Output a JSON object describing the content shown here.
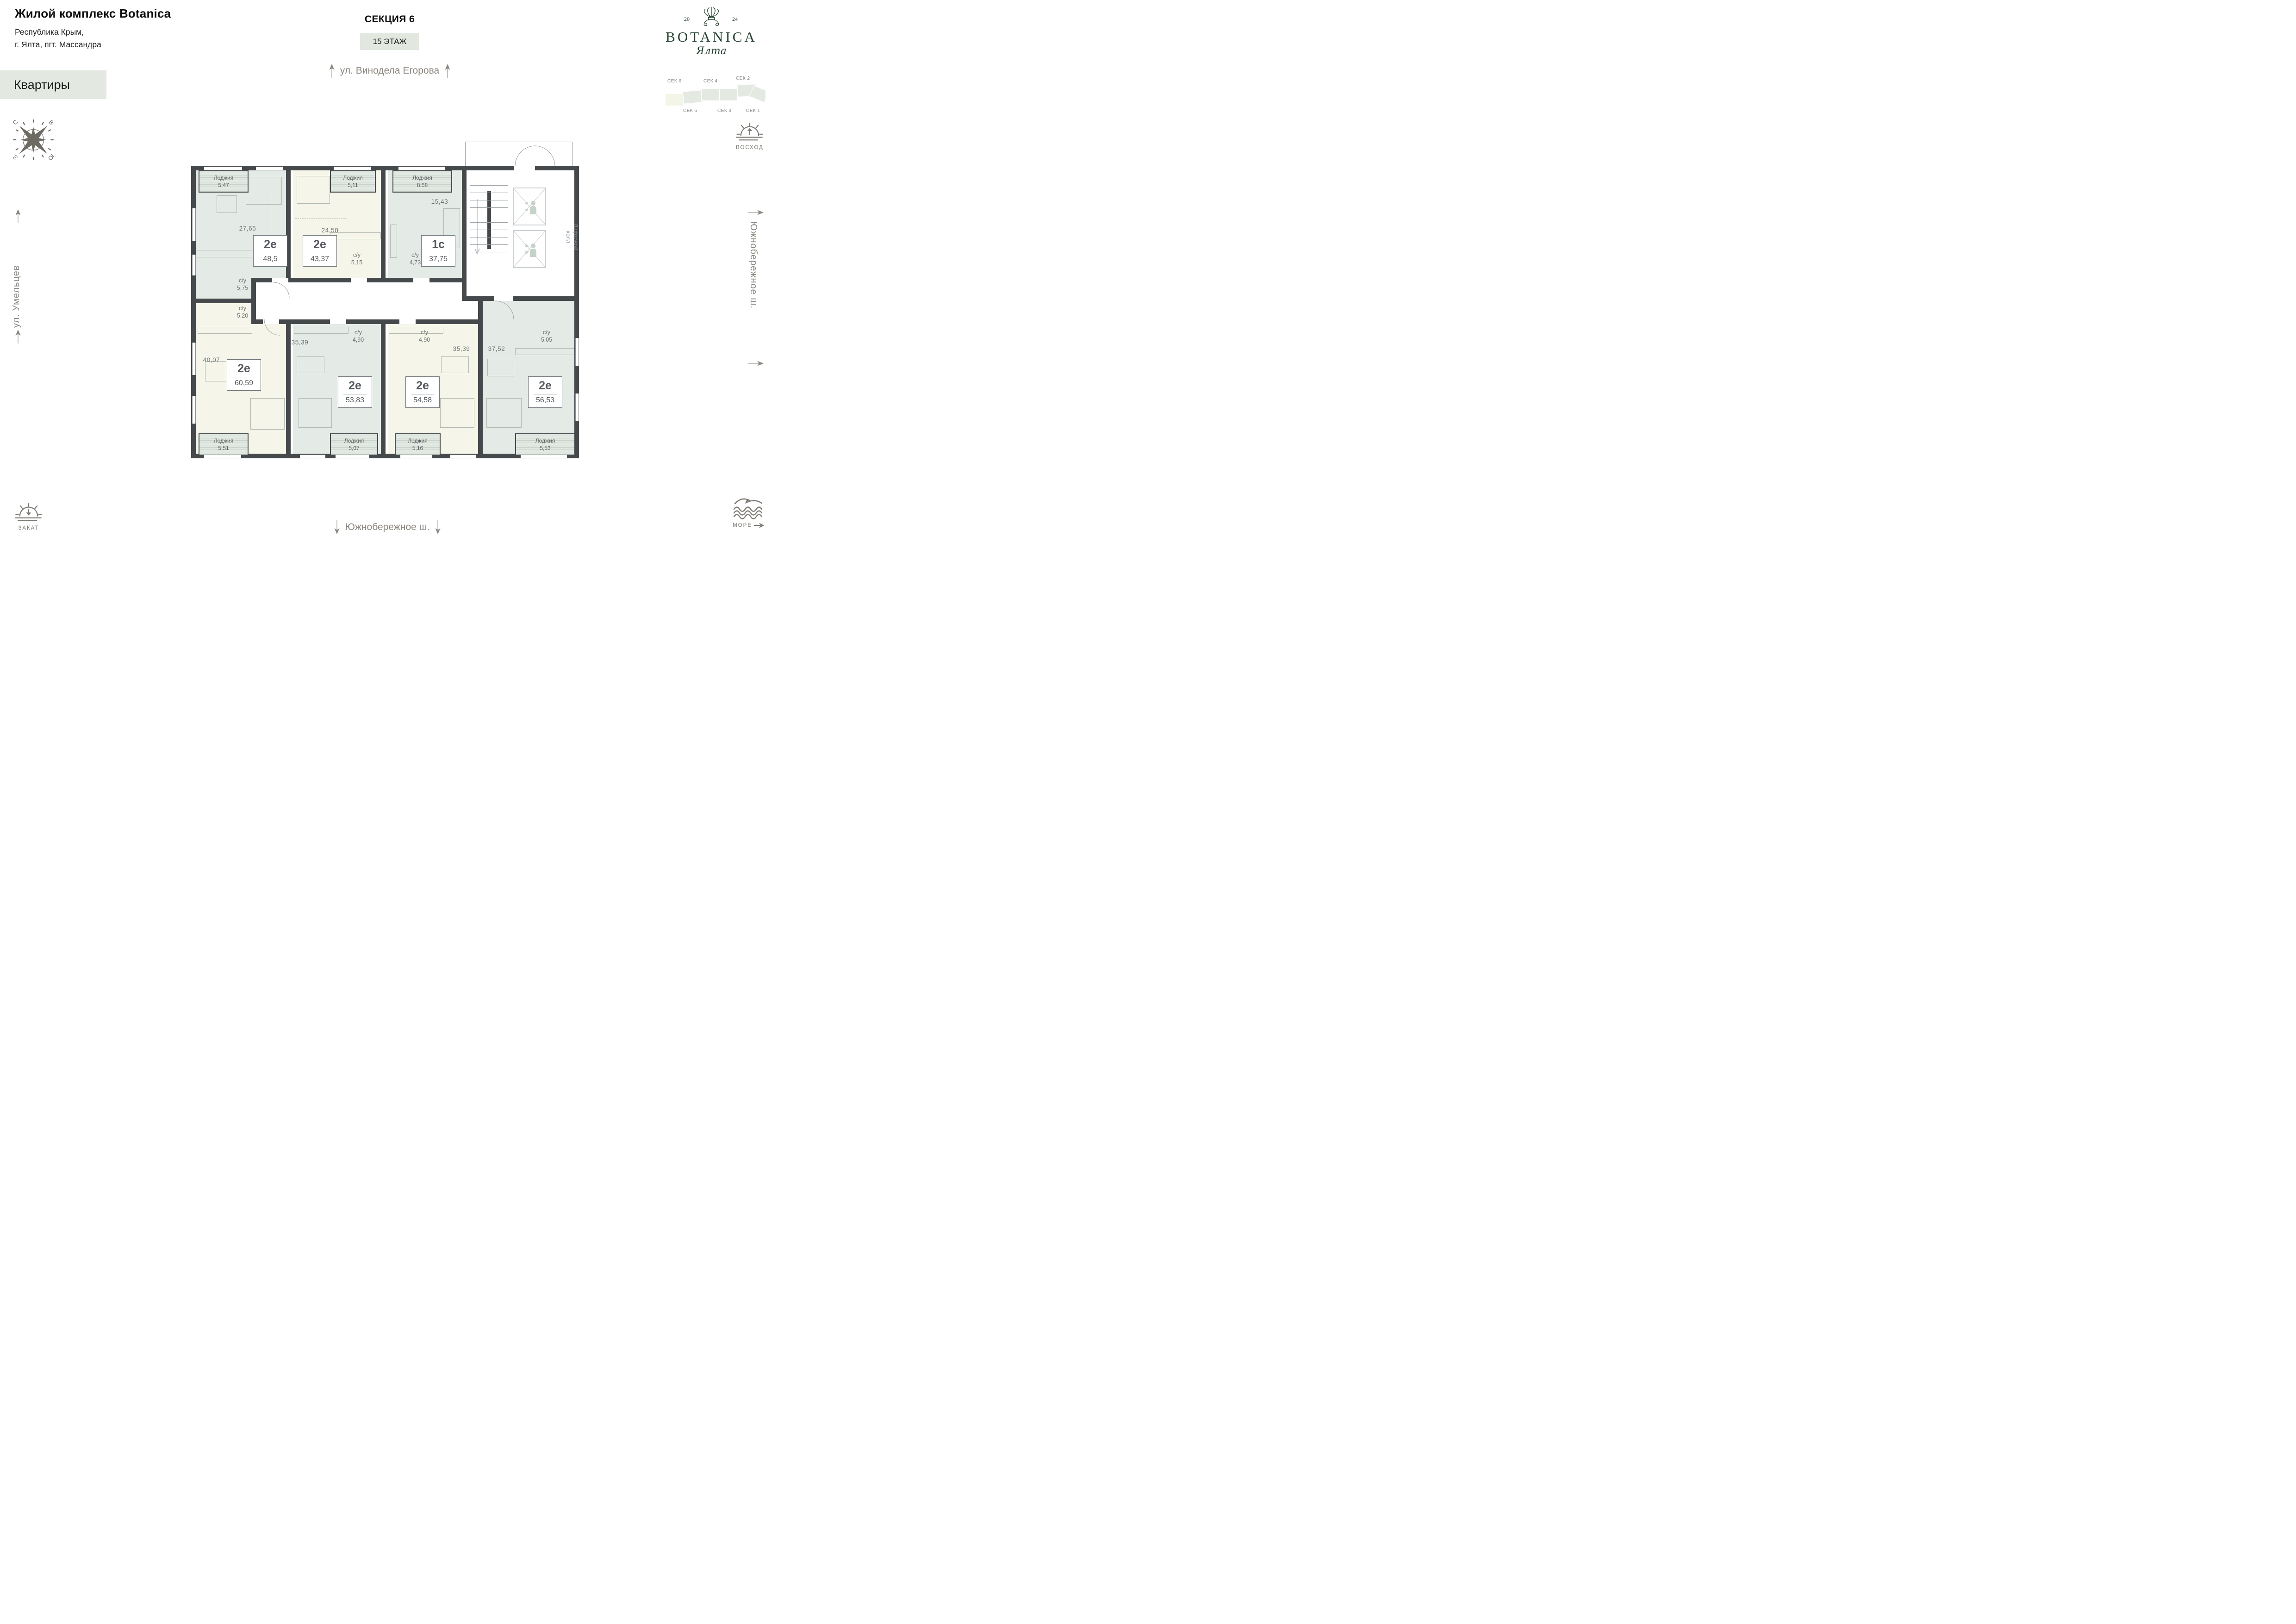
{
  "header": {
    "title": "Жилой комплекс Botanica",
    "address1": "Республика Крым,",
    "address2": "г. Ялта, пгт. Массандра",
    "apartments_badge": "Квартиры",
    "section_title": "СЕКЦИЯ 6",
    "floor_badge": "15 ЭТАЖ"
  },
  "logo": {
    "year_left": "20",
    "year_right": "24",
    "brand": "BOTANICA",
    "city": "Ялта"
  },
  "section_map": {
    "top_labels": [
      "СЕК 6",
      "СЕК 4",
      "СЕК 2"
    ],
    "bottom_labels": [
      "СЕК 5",
      "СЕК 3",
      "СЕК 1"
    ],
    "highlighted": "СЕК 6"
  },
  "streets": {
    "top": "ул. Винодела Егорова",
    "left": "ул. Умельцев",
    "right": "Южнобережное ш.",
    "bottom": "Южнобережное ш."
  },
  "compass": {
    "n": "С",
    "e": "В",
    "w": "З",
    "s": "Ю"
  },
  "landmarks": {
    "sunrise": "ВОСХОД",
    "sunset": "ЗАКАТ",
    "sea": "МОРЕ"
  },
  "labels": {
    "wc": "с/у",
    "loggia": "Лоджия"
  },
  "floor_plan": {
    "elevator_hall": {
      "line1": "Лифтовой",
      "line2": "холл"
    },
    "apartments": [
      {
        "type": "2е",
        "area": "48,5",
        "room": "27,65",
        "wc_area": "5,75",
        "loggia_area": "5,47"
      },
      {
        "type": "2е",
        "area": "43,37",
        "room": "24,50",
        "wc_area": "5,15",
        "loggia_area": "5,11"
      },
      {
        "type": "1с",
        "area": "37,75",
        "room": "15,43",
        "wc_area": "4,73",
        "loggia_area": "8,58"
      },
      {
        "type": "2е",
        "area": "60,59",
        "room": "40,07",
        "wc_area": "5,20",
        "loggia_area": "5,51"
      },
      {
        "type": "2е",
        "area": "53,83",
        "room": "35,39",
        "wc_area": "4,90",
        "loggia_area": "5,07"
      },
      {
        "type": "2е",
        "area": "54,58",
        "room": "35,39",
        "wc_area": "4,90",
        "loggia_area": "5,16"
      },
      {
        "type": "2е",
        "area": "56,53",
        "room": "37,52",
        "wc_area": "5,05",
        "loggia_area": "5,53"
      }
    ]
  },
  "colors": {
    "wall": "#46494c",
    "apartment_sage": "#e4eae5",
    "apartment_cream": "#f5f6e9",
    "badge_bg": "#e3e8e1",
    "brand_green": "#24412f",
    "street_gray": "#8b867f",
    "plan_text_gray": "#6b7074"
  }
}
